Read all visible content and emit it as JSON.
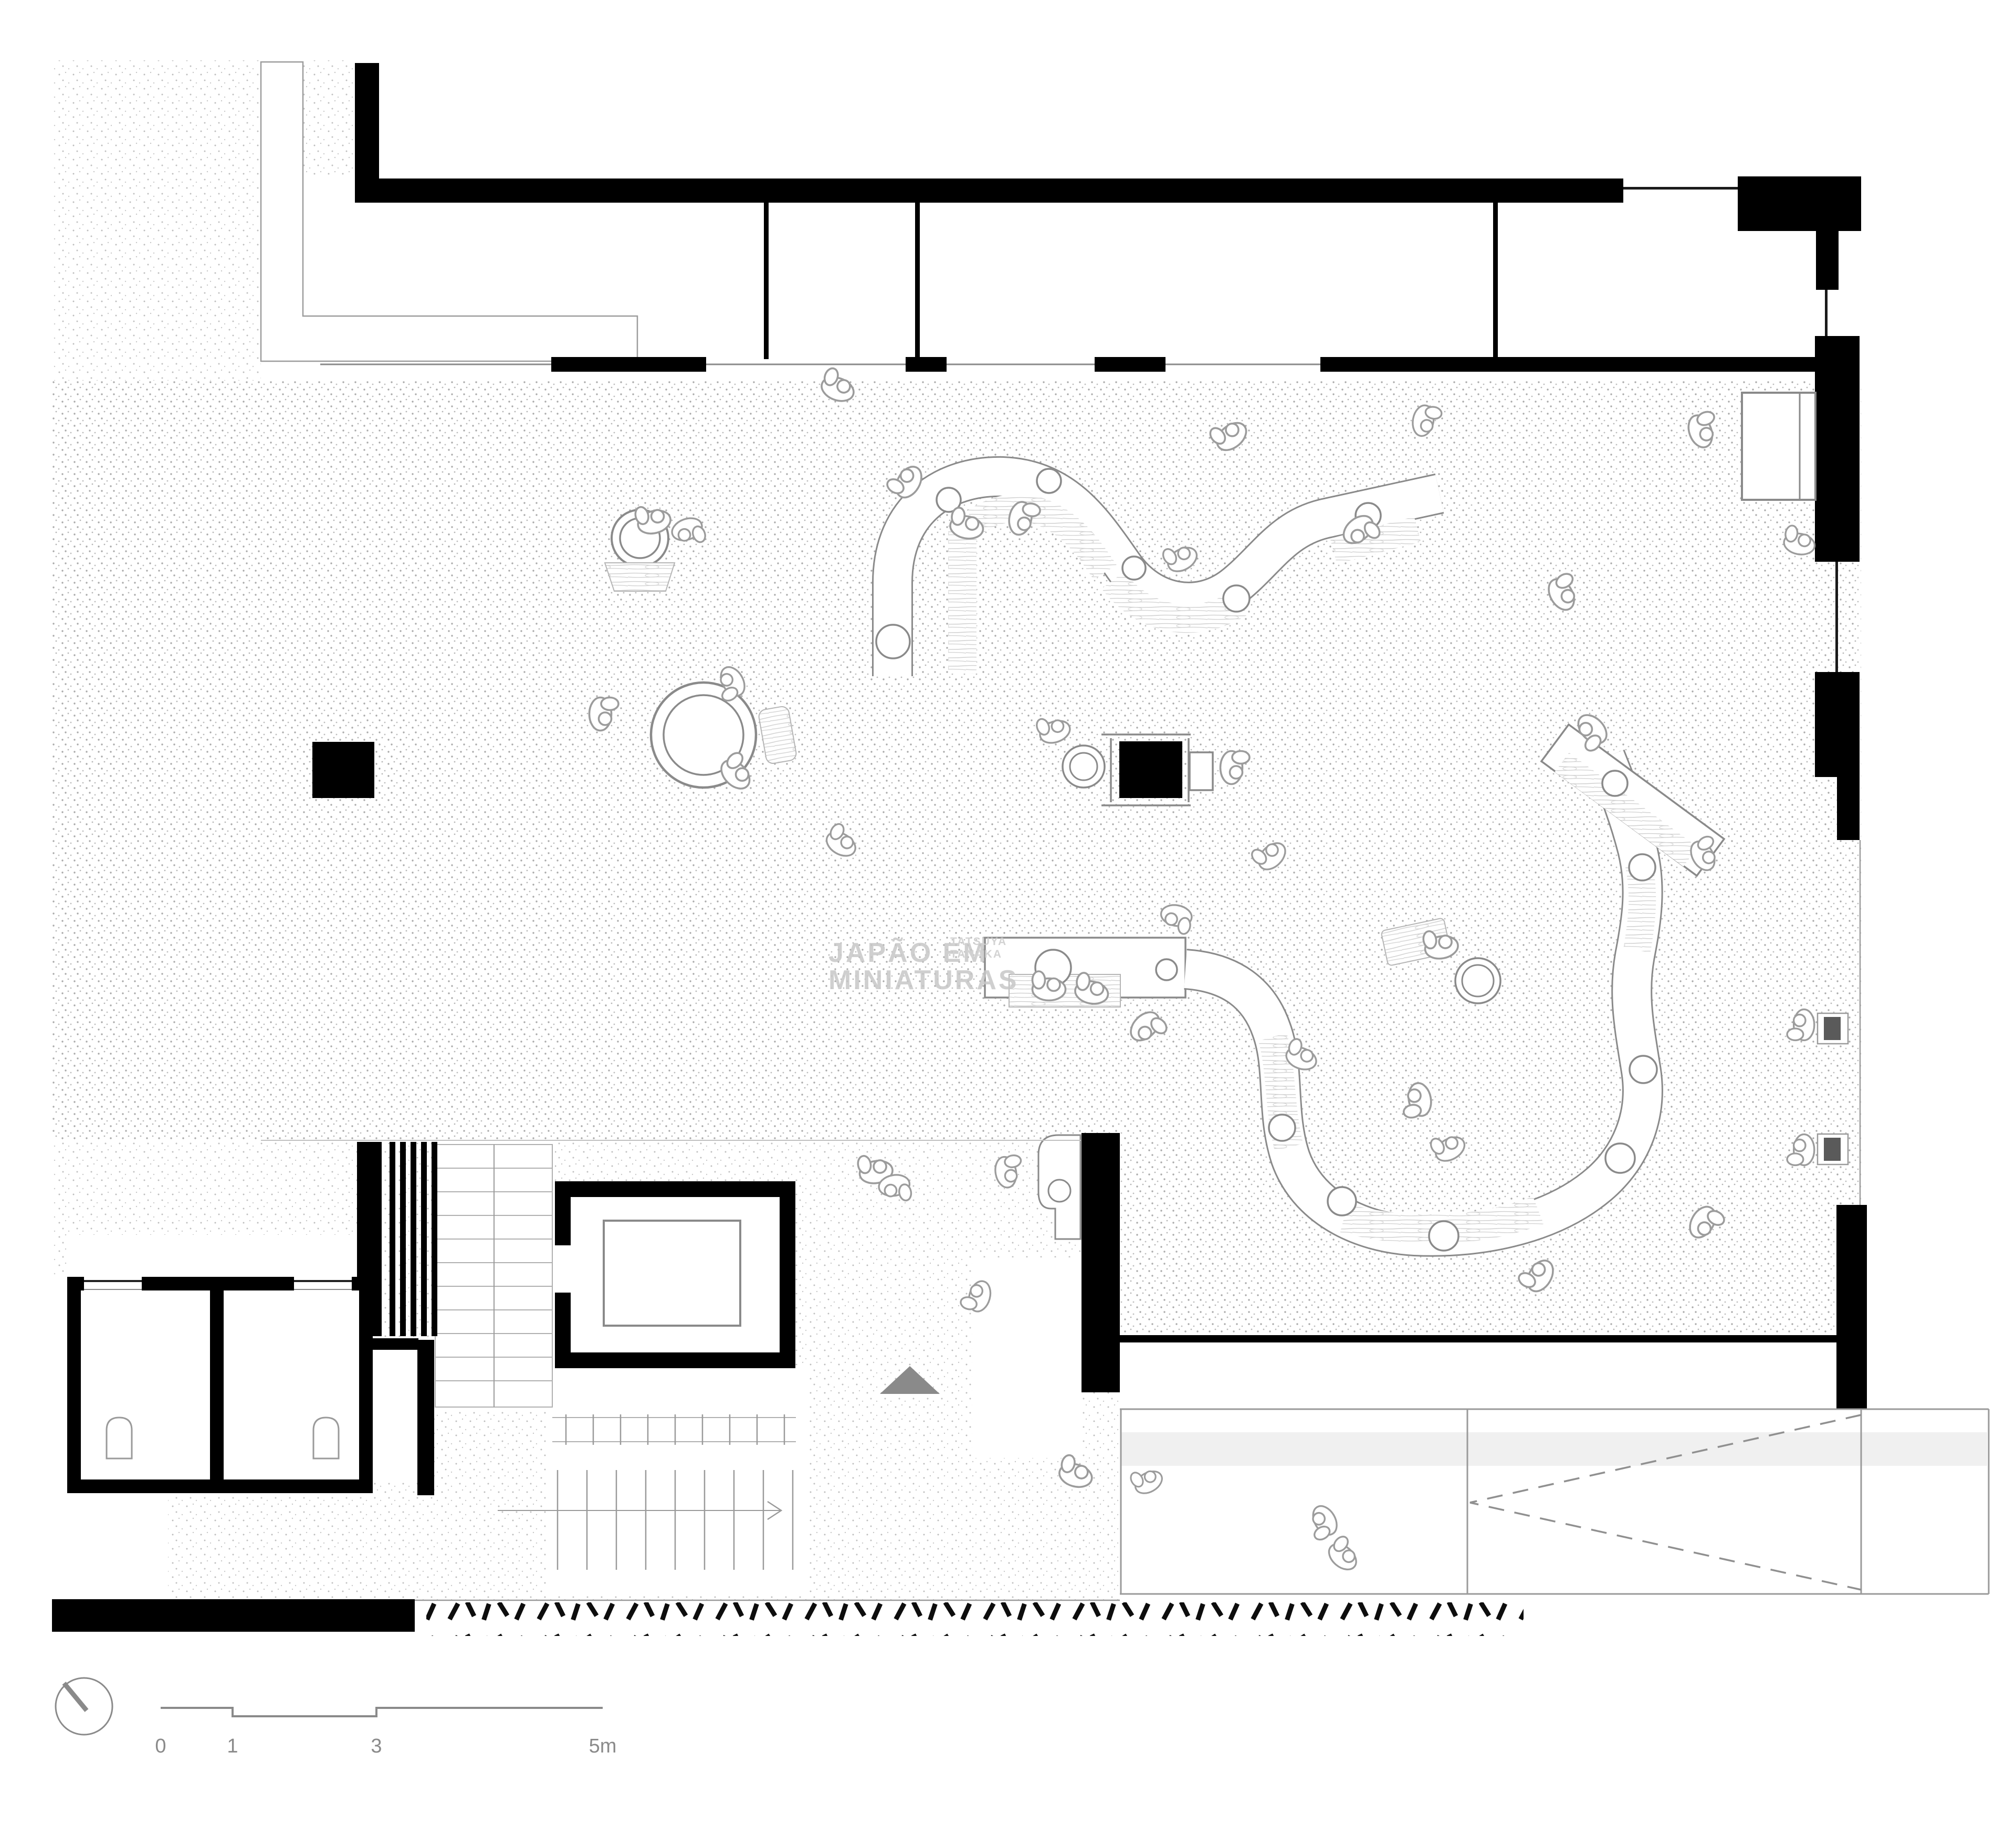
{
  "plan": {
    "kind": "architectural-floor-plan",
    "watermark": {
      "line1": "JAPÃO EM",
      "line2": "MINIATURAS",
      "credit1": "TATSUYA",
      "credit2": "TANAKA"
    },
    "scalebar": {
      "tick0": "0",
      "tick1": "1",
      "tick3": "3",
      "tick5": "5m"
    },
    "colors": {
      "wall": "#000000",
      "outline": "#8a8a8a",
      "stipple": "#b0b0b0",
      "wood": "#cfcfcf",
      "mat": "#f0f0f0",
      "watermark": "#c7c7c7"
    },
    "icons": [
      "north-indicator",
      "stair-direction-arrow",
      "door-swing-dashed",
      "toilet-icon"
    ]
  }
}
